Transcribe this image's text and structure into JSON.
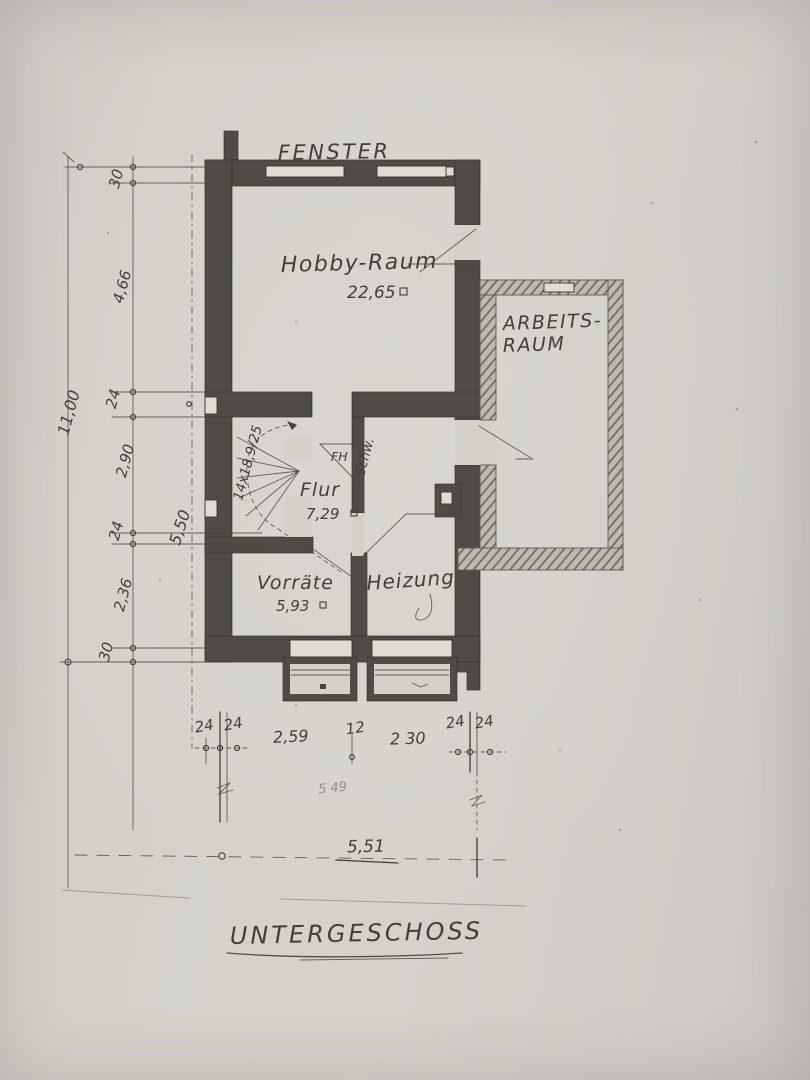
{
  "plan": {
    "title": "UNTERGESCHOSS",
    "window_label": "FENSTER",
    "rooms": {
      "hobby": {
        "name": "Hobby-Raum",
        "area": "22,65"
      },
      "arbeits": {
        "name_line1": "ARBEITS-",
        "name_line2": "RAUM"
      },
      "flur": {
        "name": "Flur",
        "area": "7,29"
      },
      "vorraete": {
        "name": "Vorräte",
        "area": "5,93"
      },
      "heizung": {
        "name": "Heizung"
      }
    },
    "annotations": {
      "stair": "14x18,9/25",
      "door": "FH",
      "schw": "Schw.",
      "faint_note": "5 49"
    }
  },
  "dimensions": {
    "left_total": "11,00",
    "stair_total": "5,50",
    "left_chain": [
      "30",
      "4,66",
      "24",
      "2,90",
      "24",
      "2,36",
      "30"
    ],
    "bottom_pair_left": [
      "24",
      "24"
    ],
    "bottom_pair_right": [
      "24",
      "24"
    ],
    "bottom_widths": [
      "2,59",
      "12",
      "2 30"
    ],
    "bottom_total": "5,51"
  },
  "colors": {
    "paper": "#d4d1cb",
    "ink": "#423f3a",
    "wall": "#4f4c48"
  }
}
